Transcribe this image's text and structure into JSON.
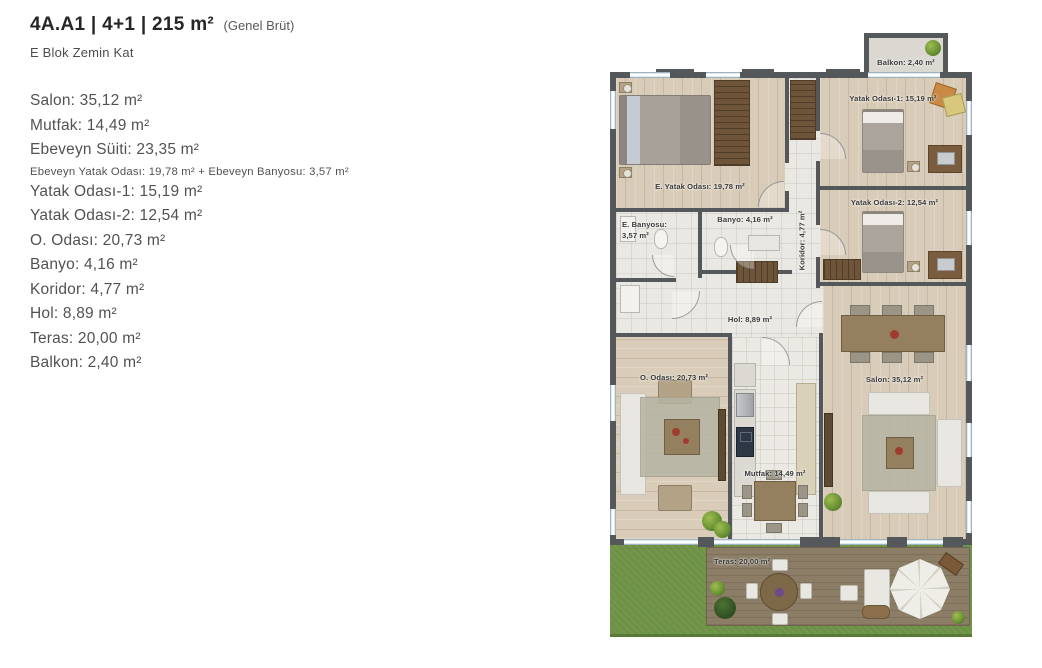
{
  "header": {
    "title": "4A.A1 | 4+1 | 215 m²",
    "title_note": "(Genel Brüt)",
    "subtitle": "E Blok Zemin Kat"
  },
  "room_list": {
    "items": [
      {
        "text": "Salon: 35,12 m²",
        "small": false
      },
      {
        "text": "Mutfak: 14,49 m²",
        "small": false
      },
      {
        "text": "Ebeveyn Süiti: 23,35 m²",
        "small": false
      },
      {
        "text": "Ebeveyn Yatak Odası: 19,78 m² + Ebeveyn Banyosu: 3,57 m²",
        "small": true
      },
      {
        "text": "Yatak Odası-1: 15,19 m²",
        "small": false
      },
      {
        "text": "Yatak Odası-2: 12,54 m²",
        "small": false
      },
      {
        "text": "O. Odası: 20,73 m²",
        "small": false
      },
      {
        "text": "Banyo: 4,16 m²",
        "small": false
      },
      {
        "text": "Koridor: 4,77 m²",
        "small": false
      },
      {
        "text": "Hol: 8,89 m²",
        "small": false
      },
      {
        "text": "Teras: 20,00 m²",
        "small": false
      },
      {
        "text": "Balkon: 2,40 m²",
        "small": false
      }
    ]
  },
  "plan": {
    "labels": {
      "balkon": "Balkon: 2,40 m²",
      "e_yatak_odasi": "E. Yatak Odası: 19,78 m²",
      "yatak_odasi_1": "Yatak Odası-1: 15,19 m²",
      "yatak_odasi_2": "Yatak Odası-2: 12,54 m²",
      "e_banyosu": "E. Banyosu:\n3,57 m²",
      "banyo": "Banyo: 4,16 m²",
      "koridor": "Koridor: 4,77 m²",
      "hol": "Hol: 8,89 m²",
      "o_odasi": "O. Odası: 20,73 m²",
      "salon": "Salon: 35,12 m²",
      "mutfak": "Mutfak: 14,49 m²",
      "teras": "Teras: 20,00 m²"
    }
  },
  "colors": {
    "wall": "#55585b",
    "wood_floor": "#d8cbb7",
    "tile_floor": "#ebe9e3",
    "grass": "#6d9145",
    "deck": "#8b7d66",
    "window_glass": "#dfeaf0",
    "label_text": "#3a3a3a"
  }
}
